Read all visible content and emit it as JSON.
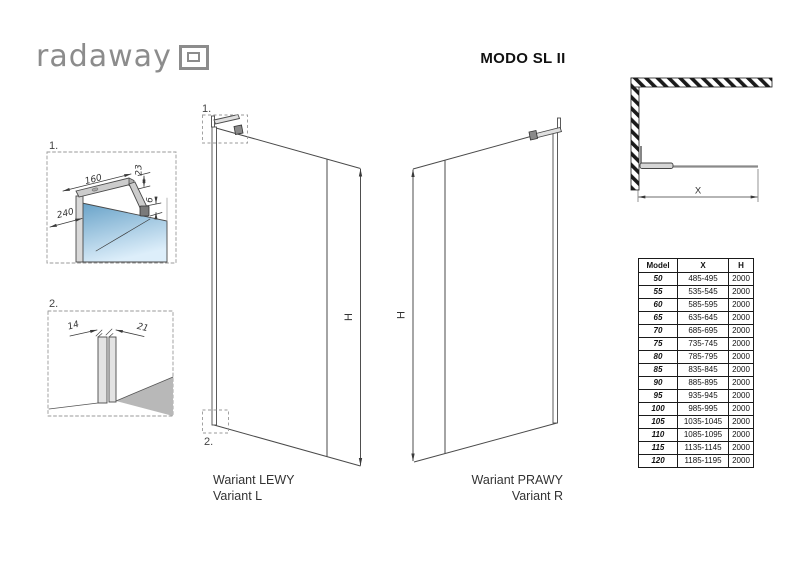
{
  "logo": {
    "text": "radaway"
  },
  "title": "MODO SL II",
  "details": {
    "label1": "1.",
    "label2": "2.",
    "d160": "160",
    "d23": "23",
    "d240": "240",
    "d6": "6",
    "d14": "14",
    "d21": "21"
  },
  "panels": {
    "left": {
      "marker_top": "1.",
      "marker_bottom": "2.",
      "h": "H",
      "caption_pl": "Wariant LEWY",
      "caption_en": "Variant L"
    },
    "right": {
      "h": "H",
      "caption_pl": "Wariant PRAWY",
      "caption_en": "Variant R"
    }
  },
  "corner": {
    "x": "X"
  },
  "table": {
    "headers": {
      "model": "Model",
      "x": "X",
      "h": "H"
    },
    "rows": [
      {
        "model": "50",
        "x": "485-495",
        "h": "2000"
      },
      {
        "model": "55",
        "x": "535-545",
        "h": "2000"
      },
      {
        "model": "60",
        "x": "585-595",
        "h": "2000"
      },
      {
        "model": "65",
        "x": "635-645",
        "h": "2000"
      },
      {
        "model": "70",
        "x": "685-695",
        "h": "2000"
      },
      {
        "model": "75",
        "x": "735-745",
        "h": "2000"
      },
      {
        "model": "80",
        "x": "785-795",
        "h": "2000"
      },
      {
        "model": "85",
        "x": "835-845",
        "h": "2000"
      },
      {
        "model": "90",
        "x": "885-895",
        "h": "2000"
      },
      {
        "model": "95",
        "x": "935-945",
        "h": "2000"
      },
      {
        "model": "100",
        "x": "985-995",
        "h": "2000"
      },
      {
        "model": "105",
        "x": "1035-1045",
        "h": "2000"
      },
      {
        "model": "110",
        "x": "1085-1095",
        "h": "2000"
      },
      {
        "model": "115",
        "x": "1135-1145",
        "h": "2000"
      },
      {
        "model": "120",
        "x": "1185-1195",
        "h": "2000"
      }
    ]
  },
  "colors": {
    "line": "#4a4a4a",
    "logo_gray": "#8c8c8c",
    "glass_blue_top": "#68a2c8",
    "glass_blue_bottom": "#ddeefa",
    "floor_gray": "#b8b8b8"
  }
}
